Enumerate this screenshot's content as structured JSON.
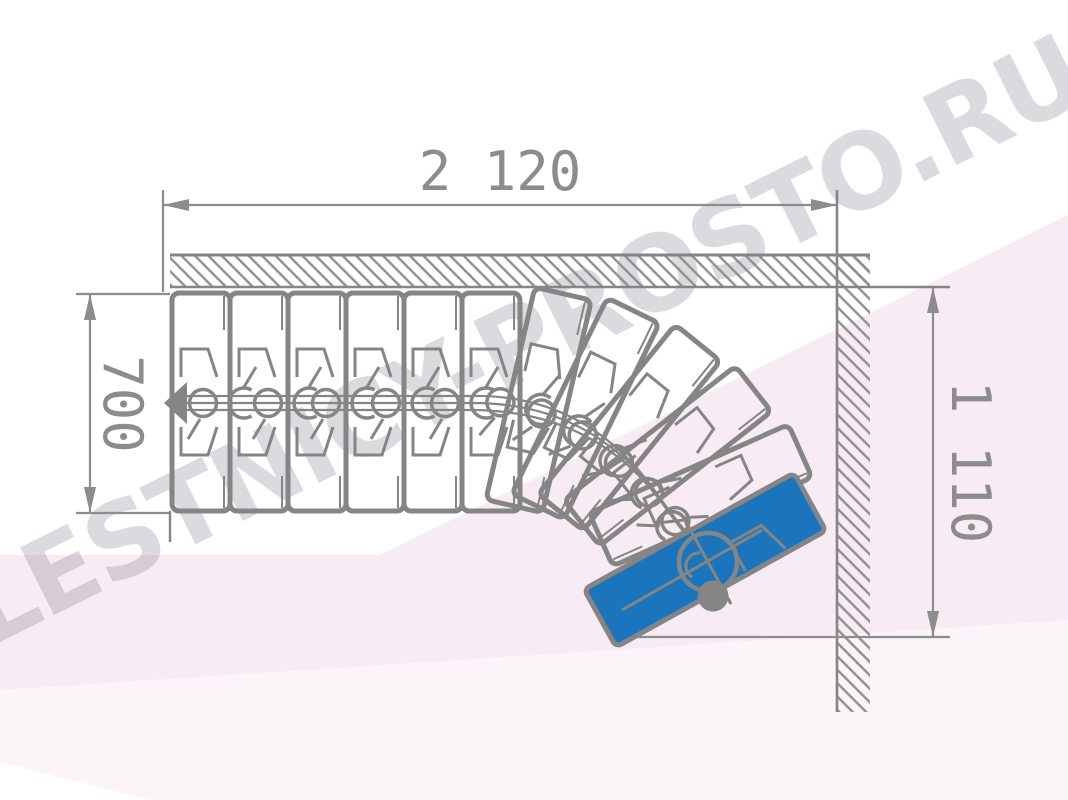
{
  "title": "Staircase plan drawing",
  "watermark": {
    "text": "LESTNICY-PROSTO.RU",
    "color": "#8f8694"
  },
  "dimensions": {
    "top": {
      "label": "2 120"
    },
    "left": {
      "label": "700"
    },
    "right": {
      "label": "1 110"
    }
  },
  "colors": {
    "line": "#858585",
    "dim": "#8c8c8c",
    "hatch": "#8f8f8f",
    "blue": "#1b75bc",
    "bg_pink": "#f7ecf3",
    "bg_pink_light": "#fbf4f8",
    "white": "#ffffff"
  },
  "stairs": {
    "straight_tread_count": 6,
    "tread_x0": 172,
    "tread_pitch": 58,
    "tread_top": 293,
    "tread_len": 218,
    "winder_base_x": 462,
    "winder_pivot": [
      524,
      610
    ],
    "winder_angles": [
      13,
      26,
      39,
      52,
      66
    ],
    "first_step": {
      "angle": -29,
      "cx": 705,
      "cy": 560,
      "w": 240,
      "h": 66
    },
    "connector_boundaries": [
      230,
      295,
      353,
      413,
      472
    ],
    "curve_connectors": [
      [
        527,
        407,
        10
      ],
      [
        566,
        425,
        25
      ],
      [
        604,
        452,
        38
      ],
      [
        637,
        483,
        48
      ],
      [
        664,
        515,
        56
      ],
      [
        688,
        545,
        62
      ]
    ],
    "pole_dot": [
      713,
      596,
      15.5
    ],
    "detail_circle": [
      708,
      562,
      29
    ]
  }
}
